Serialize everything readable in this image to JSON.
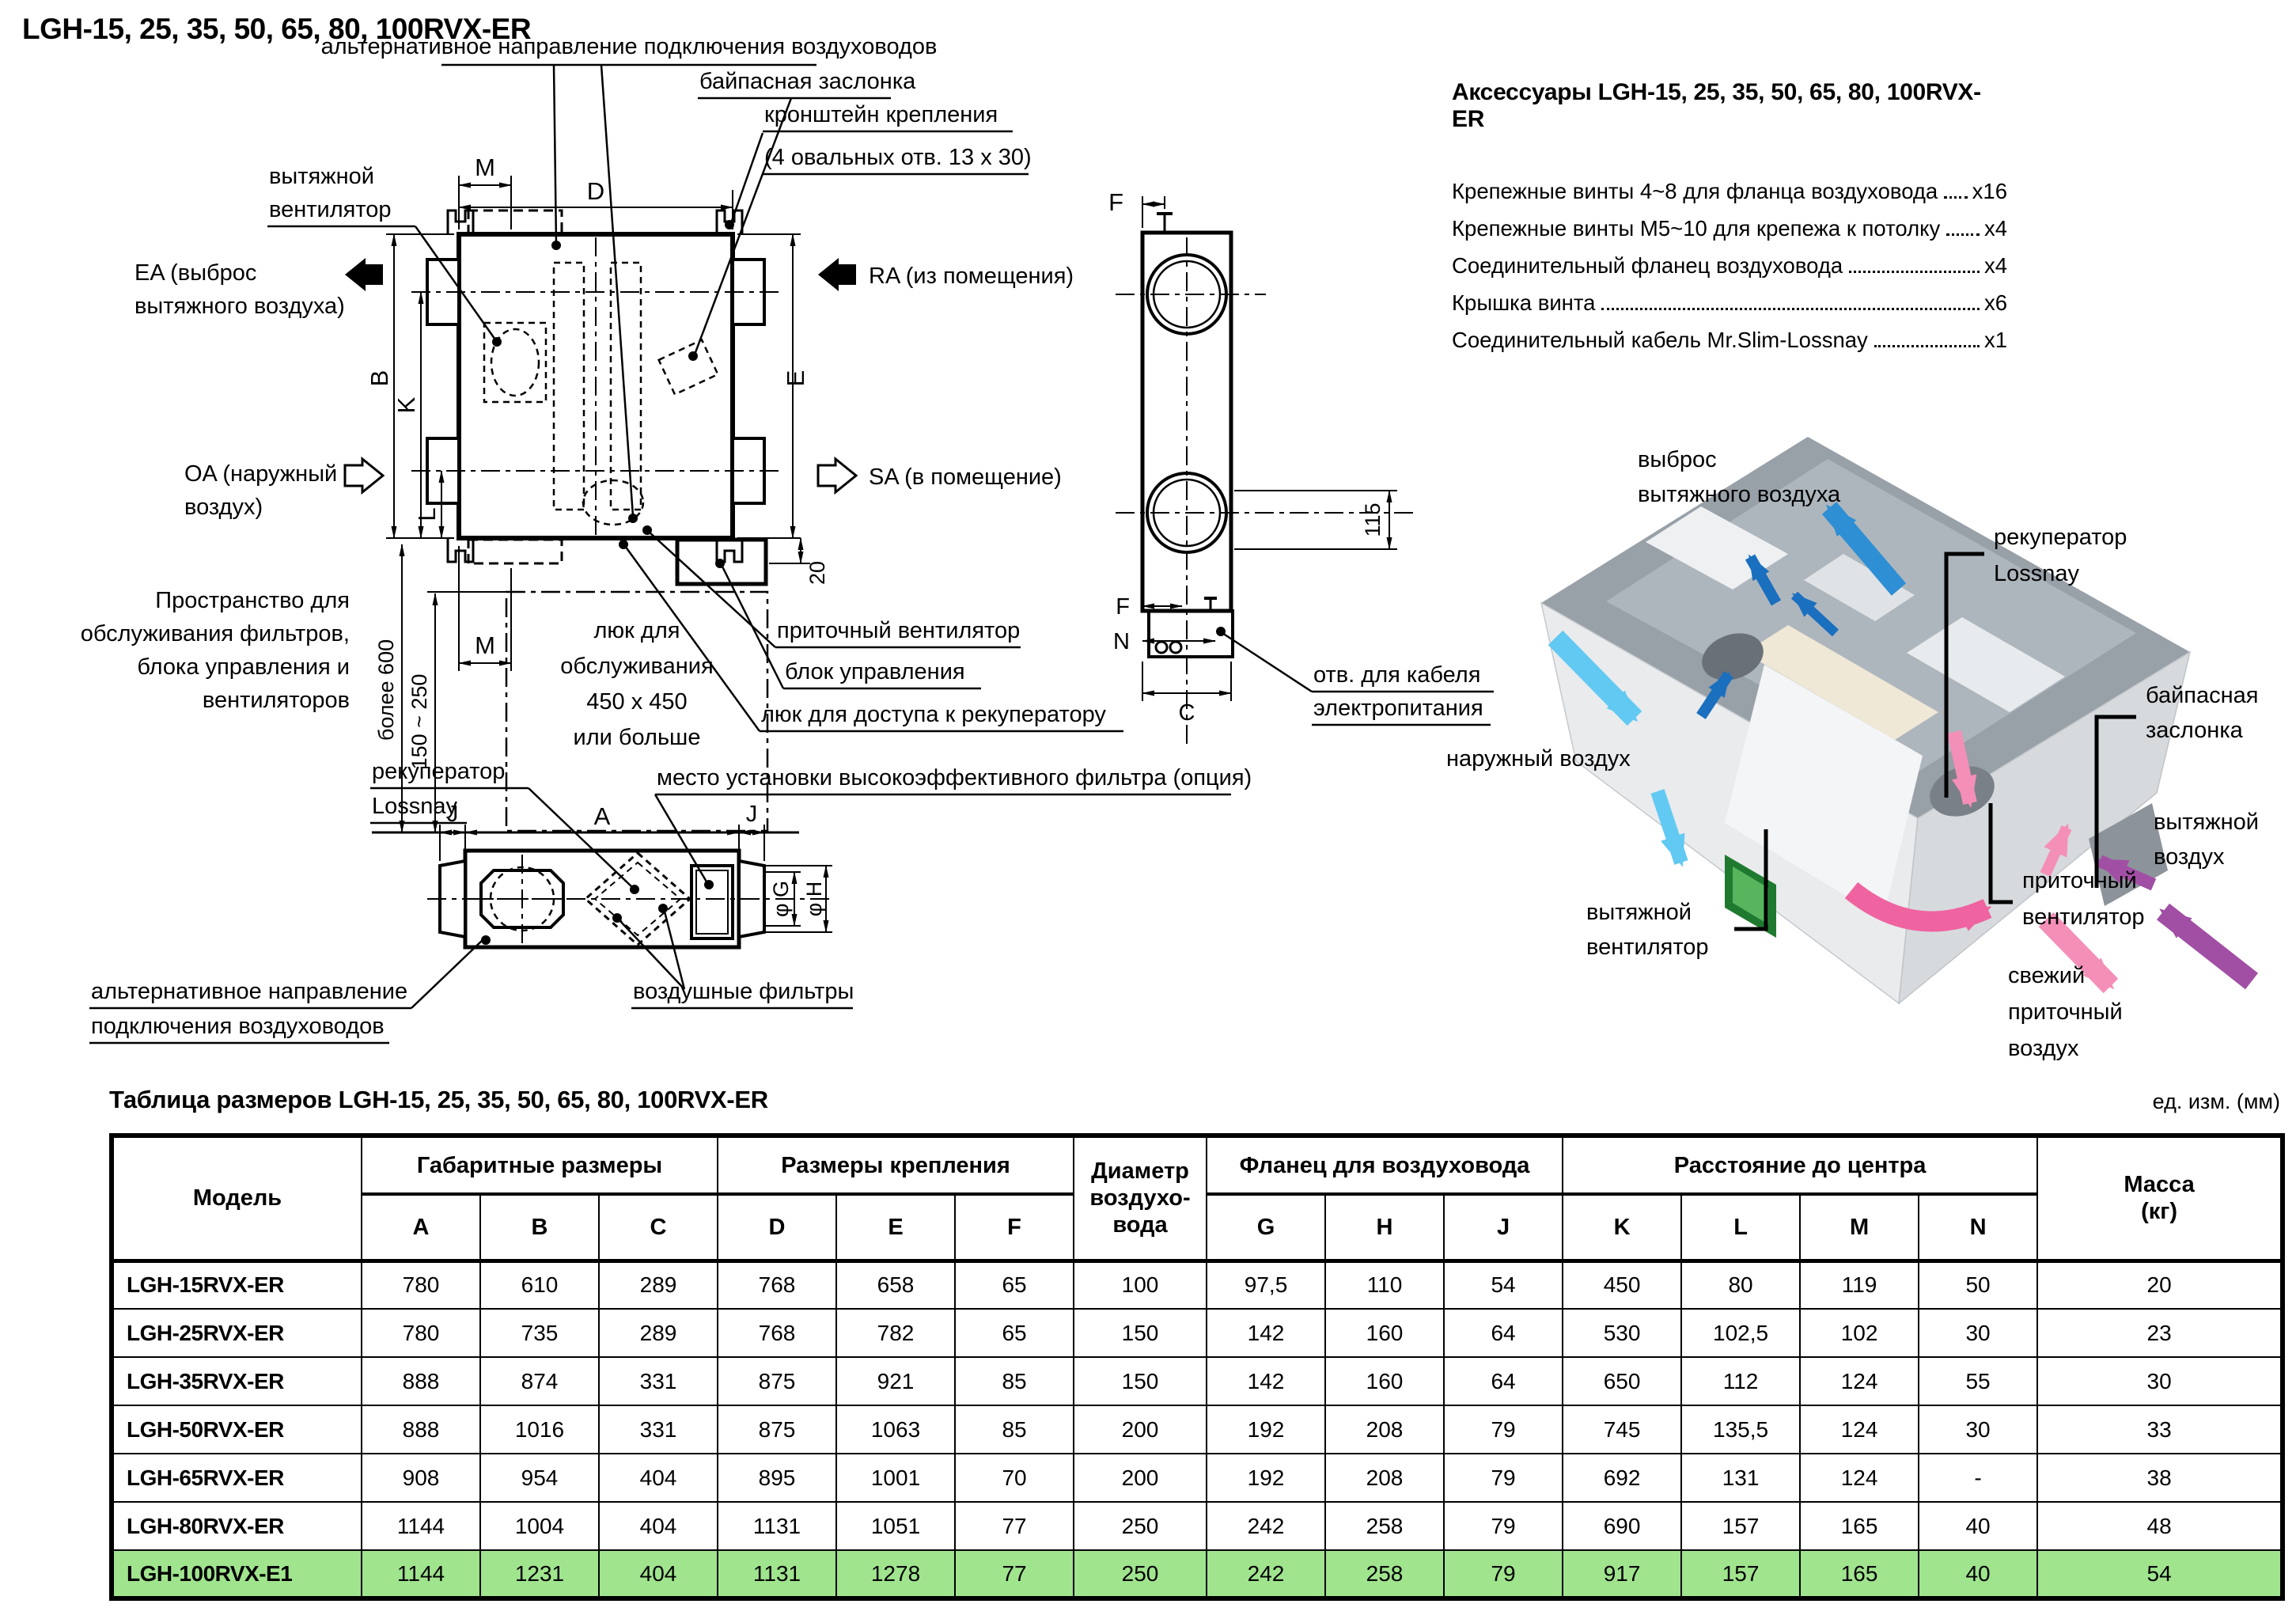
{
  "page": {
    "title": "LGH-15, 25, 35, 50, 65, 80, 100RVX-ER"
  },
  "accessories": {
    "title": "Аксессуары LGH-15, 25, 35, 50, 65, 80, 100RVX-ER",
    "items": [
      {
        "label": "Крепежные винты 4~8 для фланца воздуховода",
        "qty": "x16"
      },
      {
        "label": "Крепежные винты М5~10 для крепежа к потолку",
        "qty": "x4"
      },
      {
        "label": "Соединительный фланец воздуховода",
        "qty": "x4"
      },
      {
        "label": "Крышка винта",
        "qty": "x6"
      },
      {
        "label": "Соединительный кабель Mr.Slim-Lossnay",
        "qty": "x1"
      }
    ]
  },
  "top_view": {
    "labels": {
      "alt_duct": "альтернативное направление подключения воздуховодов",
      "bypass": "байпасная заслонка",
      "bracket_line1": "кронштейн крепления",
      "bracket_line2": "(4 овальных отв. 13 x 30)",
      "exhaust_fan_line1": "вытяжной",
      "exhaust_fan_line2": "вентилятор",
      "ea_line1": "EA (выброс",
      "ea_line2": "вытяжного воздуха)",
      "oa_line1": "OA (наружный",
      "oa_line2": "воздух)",
      "ra": "RA (из помещения)",
      "sa": "SA (в помещение)",
      "service_line1": "Пространство для",
      "service_line2": "обслуживания фильтров,",
      "service_line3": "блока управления и",
      "service_line4": "вентиляторов",
      "hatch_line1": "люк для",
      "hatch_line2": "обслуживания",
      "hatch_line3": "450 x 450",
      "hatch_line4": "или больше",
      "supply_fan": "приточный вентилятор",
      "control_box": "блок управления",
      "hx_hatch": "люк для доступа к рекуператору"
    },
    "dims": {
      "m": "M",
      "d": "D",
      "b": "B",
      "k": "K",
      "l": "L",
      "e": "E",
      "twenty": "20",
      "min_space": "более 600",
      "range": "150 ~ 250"
    }
  },
  "side_view": {
    "dims": {
      "f": "F",
      "n": "N",
      "c": "C",
      "offset115": "115"
    },
    "labels": {
      "cable_line1": "отв. для кабеля",
      "cable_line2": "электропитания"
    }
  },
  "bottom_view": {
    "labels": {
      "hx_line1": "рекуператор",
      "hx_line2": "Lossnay",
      "filter_option": "место установки высокоэффективного фильтра (опция)",
      "alt_line1": "альтернативное направление",
      "alt_line2": "подключения воздуховодов",
      "air_filters": "воздушные фильтры"
    },
    "dims": {
      "j": "J",
      "a": "A",
      "g": "φ G",
      "h": "φ H"
    }
  },
  "illustration": {
    "labels": {
      "exhaust_out_line1": "выброс",
      "exhaust_out_line2": "вытяжного воздуха",
      "hx_line1": "рекуператор",
      "hx_line2": "Lossnay",
      "bypass_line1": "байпасная",
      "bypass_line2": "заслонка",
      "outdoor_air": "наружный воздух",
      "exhaust_fan_line1": "вытяжной",
      "exhaust_fan_line2": "вентилятор",
      "supply_fan_line1": "приточный",
      "supply_fan_line2": "вентилятор",
      "fresh_line1": "свежий",
      "fresh_line2": "приточный",
      "fresh_line3": "воздух",
      "return_line1": "вытяжной",
      "return_line2": "воздух"
    },
    "colors": {
      "outdoor": "#62c9f2",
      "exhaust": "#2e8fd4",
      "exhaust_dark": "#1a6fbf",
      "supply": "#f48fb8",
      "supply_dark": "#ef63a0",
      "return": "#a14fa5"
    }
  },
  "table": {
    "title": "Таблица размеров LGH-15, 25, 35, 50, 65, 80, 100RVX-ER",
    "unit_note": "ед. изм. (мм)",
    "highlight_color": "#a0e48e",
    "col_model": "Модель",
    "grp_overall": "Габаритные размеры",
    "grp_mounting": "Размеры крепления",
    "col_duct": "Диаметр\nвоздухо-\nвода",
    "grp_flange": "Фланец для воздуховода",
    "grp_center": "Расстояние до центра",
    "col_mass": "Масса\n(кг)",
    "sub_headers": [
      "A",
      "B",
      "C",
      "D",
      "E",
      "F",
      "G",
      "H",
      "J",
      "K",
      "L",
      "M",
      "N"
    ],
    "rows": [
      {
        "model": "LGH-15RVX-ER",
        "highlight": false,
        "values": [
          "780",
          "610",
          "289",
          "768",
          "658",
          "65",
          "100",
          "97,5",
          "110",
          "54",
          "450",
          "80",
          "119",
          "50",
          "20"
        ]
      },
      {
        "model": "LGH-25RVX-ER",
        "highlight": false,
        "values": [
          "780",
          "735",
          "289",
          "768",
          "782",
          "65",
          "150",
          "142",
          "160",
          "64",
          "530",
          "102,5",
          "102",
          "30",
          "23"
        ]
      },
      {
        "model": "LGH-35RVX-ER",
        "highlight": false,
        "values": [
          "888",
          "874",
          "331",
          "875",
          "921",
          "85",
          "150",
          "142",
          "160",
          "64",
          "650",
          "112",
          "124",
          "55",
          "30"
        ]
      },
      {
        "model": "LGH-50RVX-ER",
        "highlight": false,
        "values": [
          "888",
          "1016",
          "331",
          "875",
          "1063",
          "85",
          "200",
          "192",
          "208",
          "79",
          "745",
          "135,5",
          "124",
          "30",
          "33"
        ]
      },
      {
        "model": "LGH-65RVX-ER",
        "highlight": false,
        "values": [
          "908",
          "954",
          "404",
          "895",
          "1001",
          "70",
          "200",
          "192",
          "208",
          "79",
          "692",
          "131",
          "124",
          "-",
          "38"
        ]
      },
      {
        "model": "LGH-80RVX-ER",
        "highlight": false,
        "values": [
          "1144",
          "1004",
          "404",
          "1131",
          "1051",
          "77",
          "250",
          "242",
          "258",
          "79",
          "690",
          "157",
          "165",
          "40",
          "48"
        ]
      },
      {
        "model": "LGH-100RVX-E1",
        "highlight": true,
        "values": [
          "1144",
          "1231",
          "404",
          "1131",
          "1278",
          "77",
          "250",
          "242",
          "258",
          "79",
          "917",
          "157",
          "165",
          "40",
          "54"
        ]
      }
    ]
  }
}
